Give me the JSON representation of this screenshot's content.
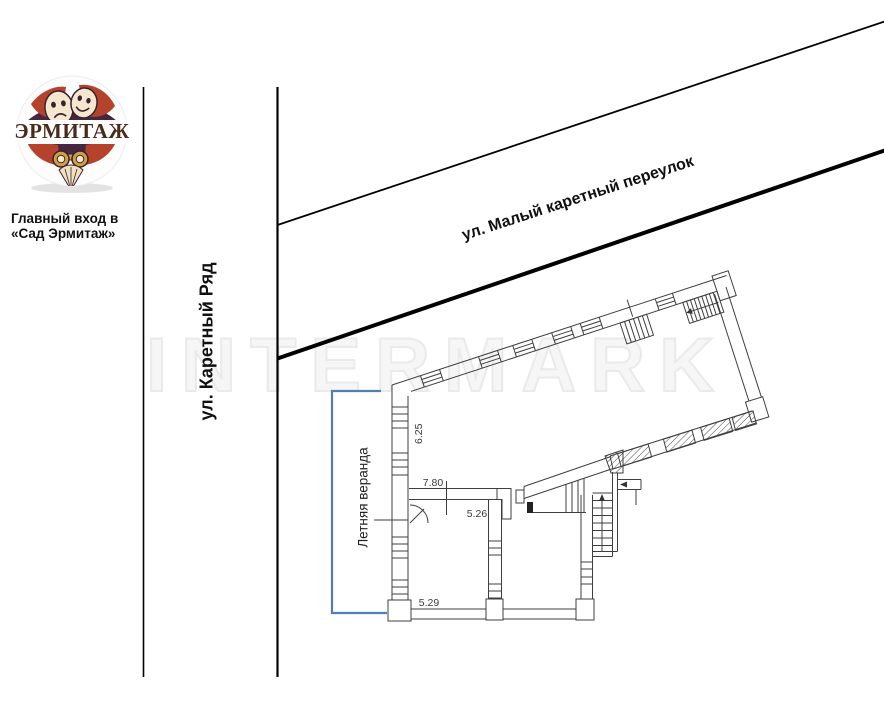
{
  "logo": {
    "text": "ЭРМИТАЖ",
    "caption_line1": "Главный вход в",
    "caption_line2": "«Сад Эрмитаж»"
  },
  "streets": {
    "vertical": "ул. Каретный Ряд",
    "diagonal": "ул. Малый каретный переулок"
  },
  "plan": {
    "veranda": "Летняя веранда",
    "dims": {
      "left": "6.25",
      "top": "7.80",
      "mid": "5.26",
      "bottom": "5.29"
    }
  },
  "watermark": "INTERMARK",
  "colors": {
    "bracket": "#4f7fb5",
    "plan_line": "#3f3f3f",
    "street_line": "#000000",
    "logo_red": "#b5432c",
    "logo_bg": "#472740",
    "logo_cream": "#f4e7cd",
    "logo_gold": "#d0a23f",
    "watermark_gray": "#eaeaea"
  }
}
